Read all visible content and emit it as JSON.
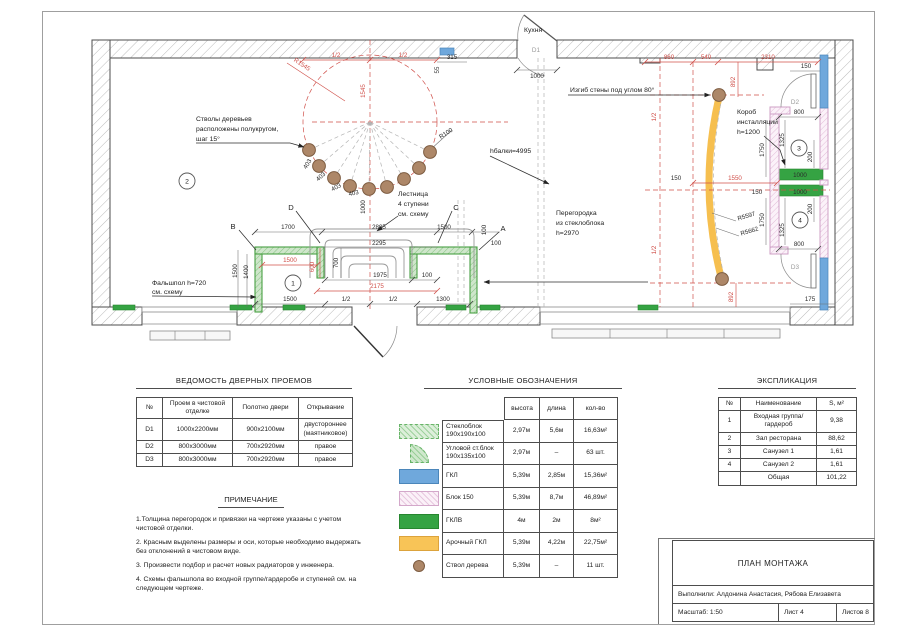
{
  "sheet": {
    "titles": {
      "doors": "ВЕДОМОСТЬ ДВЕРНЫХ ПРОЕМОВ",
      "legend": "УСЛОВНЫЕ ОБОЗНАЧЕНИЯ",
      "explication": "ЭКСПЛИКАЦИЯ",
      "notes": "ПРИМЕЧАНИЕ"
    },
    "title_block": {
      "title": "ПЛАН МОНТАЖА",
      "authors": "Выполнили: Алдонина Анастасия, Рябова Елизавета",
      "scale": "Масштаб: 1:50",
      "sheet": "Лист 4",
      "sheets": "Листов 8"
    }
  },
  "door_schedule": {
    "headers": [
      "№",
      "Проем в чистовой отделке",
      "Полотно двери",
      "Открывание"
    ],
    "rows": [
      [
        "D1",
        "1000х2200мм",
        "900х2100мм",
        "двустороннее (маятниковое)"
      ],
      [
        "D2",
        "800х3000мм",
        "700х2920мм",
        "правое"
      ],
      [
        "D3",
        "800х3000мм",
        "700х2920мм",
        "правое"
      ]
    ]
  },
  "legend": {
    "headers": [
      "высота",
      "длина",
      "кол-во"
    ],
    "rows": [
      {
        "swatch": "glassblock",
        "name": "Стеклоблок 190х190х100",
        "height": "2,97м",
        "length": "5,6м",
        "qty": "16,63м²"
      },
      {
        "swatch": "corner-glassblock",
        "name": "Угловой ст.блок 190х135х100",
        "height": "2,97м",
        "length": "–",
        "qty": "63 шт."
      },
      {
        "swatch": "gkl",
        "name": "ГКЛ",
        "height": "5,39м",
        "length": "2,85м",
        "qty": "15,36м²"
      },
      {
        "swatch": "blok150",
        "name": "Блок 150",
        "height": "5,39м",
        "length": "8,7м",
        "qty": "46,89м²"
      },
      {
        "swatch": "gklv",
        "name": "ГКЛВ",
        "height": "4м",
        "length": "2м",
        "qty": "8м²"
      },
      {
        "swatch": "arch-gkl",
        "name": "Арочный ГКЛ",
        "height": "5,39м",
        "length": "4,22м",
        "qty": "22,75м²"
      },
      {
        "swatch": "trunk",
        "name": "Ствол дерева",
        "height": "5,39м",
        "length": "–",
        "qty": "11 шт."
      }
    ]
  },
  "explication": {
    "headers": [
      "№",
      "Наименование",
      "S, м²"
    ],
    "rows": [
      [
        "1",
        "Входная группа/ гардероб",
        "9,38"
      ],
      [
        "2",
        "Зал ресторана",
        "88,62"
      ],
      [
        "3",
        "Санузел 1",
        "1,61"
      ],
      [
        "4",
        "Санузел 2",
        "1,61"
      ],
      [
        "",
        "Общая",
        "101,22"
      ]
    ]
  },
  "notes": {
    "items": [
      "1.Толщина перегородок и привязки на чертеже указаны с учетом чистовой отделки.",
      "2. Красным выделены размеры и оси, которые необходимо выдержать без отклонений в чистовом виде.",
      "3. Произвести подбор и расчет новых радиаторов у инженера.",
      "4. Схемы фальшпола во входной группе/гардеробе и ступеней см. на следующем чертеже."
    ]
  },
  "plan": {
    "rooms": [
      "1",
      "2",
      "3",
      "4"
    ],
    "axes": {
      "a": "A",
      "b": "B",
      "c": "C",
      "d": "D"
    },
    "doors": {
      "d1": "D1",
      "d2": "D2",
      "d3": "D3"
    },
    "labels": {
      "kitchen": "Кухня"
    },
    "ann": {
      "trees": [
        "Стволы деревьев",
        "расположены полукругом,",
        "шаг 15°"
      ],
      "stairs": [
        "Лестница",
        "4 ступени",
        "см. схему"
      ],
      "bend": "Изгиб стены под углом 80°",
      "duct": [
        "Короб",
        "инсталляции",
        "h=1200"
      ],
      "partition": [
        "Перегородка",
        "из стеклоблока",
        "h=2970"
      ],
      "floor": [
        "Фальшпол h=720",
        "см. схему"
      ],
      "beam": "hбалки=4995"
    },
    "dims": {
      "half": "1/2",
      "d55": "55",
      "d100": "100",
      "d150": "150",
      "d175": "175",
      "d200": "200",
      "d315": "315",
      "d403": "403",
      "d540": "540",
      "d600": "600",
      "d700": "700",
      "d800": "800",
      "d860": "860",
      "d892": "892",
      "d1000": "1000",
      "d1300": "1300",
      "d1325": "1325",
      "d1400": "1400",
      "d1500": "1500",
      "d1545": "1545",
      "d1550": "1550",
      "d1700": "1700",
      "d1750": "1750",
      "d1975": "1975",
      "d2175": "2175",
      "d2295": "2295",
      "d2310": "2310",
      "d2895": "2895",
      "r100": "R100",
      "r1545": "R1545",
      "r5597": "R5597",
      "r5662": "R5662"
    }
  },
  "colors": {
    "dim_red": "#d0504a",
    "wall_green": "#49a043",
    "gklv_green": "#35a343",
    "gkl_blue": "#6fa8dc",
    "blok_pink": "#d3a8ca",
    "arch_orange": "#f8c457",
    "trunk_brown": "#ad8768"
  }
}
